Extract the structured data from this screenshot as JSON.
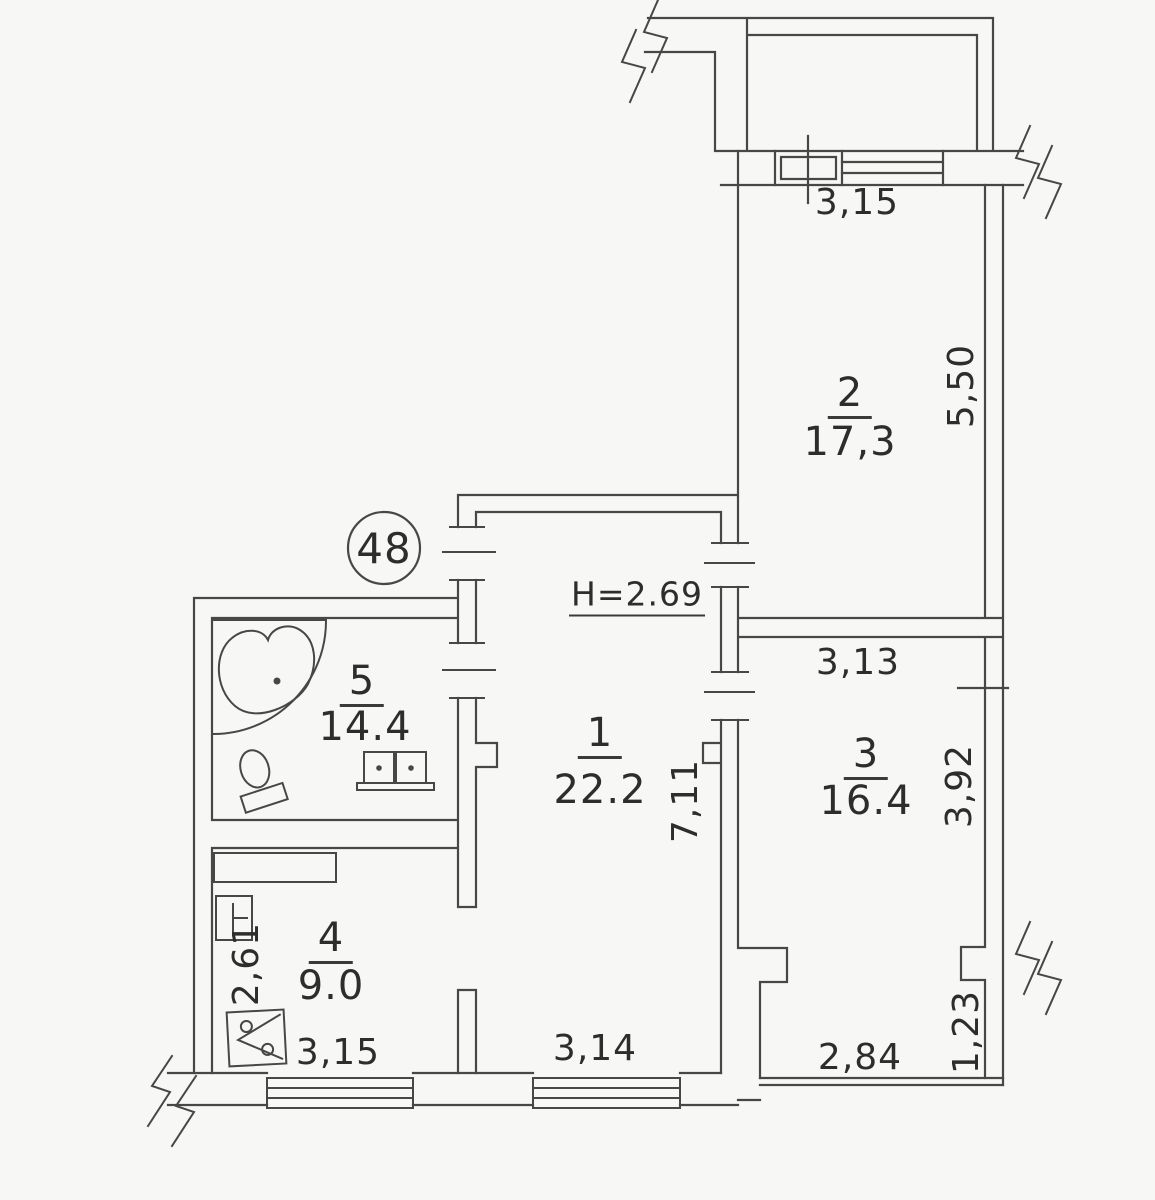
{
  "apartment": {
    "number": "48",
    "ceiling_height_note": "H=2.69"
  },
  "rooms": [
    {
      "number": "1",
      "area": "22.2"
    },
    {
      "number": "2",
      "area": "17,3"
    },
    {
      "number": "3",
      "area": "16.4"
    },
    {
      "number": "4",
      "area": "9.0"
    },
    {
      "number": "5",
      "area": "14.4"
    }
  ],
  "dimensions": {
    "balcony_window_width": "3,15",
    "room2_depth": "5,50",
    "room3_width": "3,13",
    "room3_depth": "3,92",
    "room1_depth": "7,11",
    "kitchen_depth": "2,61",
    "kitchen_width": "3,15",
    "room1_width": "3,14",
    "bottom_extension_width": "2,84",
    "bottom_right_wall": "1,23"
  }
}
